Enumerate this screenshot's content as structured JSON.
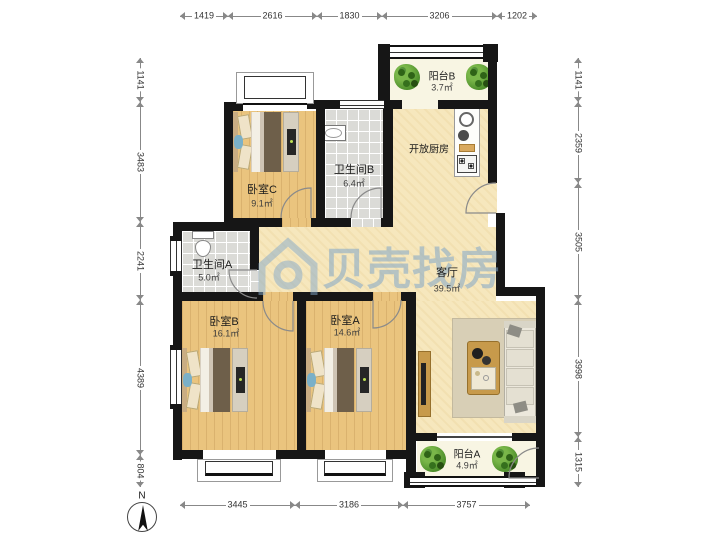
{
  "watermark": {
    "text": "贝壳找房"
  },
  "compass": {
    "label": "N"
  },
  "rooms": {
    "bedroomC": {
      "name": "卧室C",
      "area": "9.1㎡"
    },
    "bathroomB": {
      "name": "卫生间B",
      "area": "6.4㎡"
    },
    "bathroomA": {
      "name": "卫生间A",
      "area": "5.0㎡"
    },
    "bedroomB": {
      "name": "卧室B",
      "area": "16.1㎡"
    },
    "bedroomA": {
      "name": "卧室A",
      "area": "14.6㎡"
    },
    "livingRoom": {
      "name": "客厅",
      "area": "39.5㎡"
    },
    "kitchen": {
      "name": "开放厨房"
    },
    "balconyB": {
      "name": "阳台B",
      "area": "3.7㎡"
    },
    "balconyA": {
      "name": "阳台A",
      "area": "4.9㎡"
    }
  },
  "dimensions": {
    "top": [
      "1419",
      "2616",
      "1830",
      "3206",
      "1202"
    ],
    "bottom": [
      "3445",
      "3186",
      "3757"
    ],
    "left": [
      "1141",
      "3483",
      "2241",
      "4389",
      "804"
    ],
    "right": [
      "1141",
      "2359",
      "3505",
      "3998",
      "1315"
    ]
  }
}
